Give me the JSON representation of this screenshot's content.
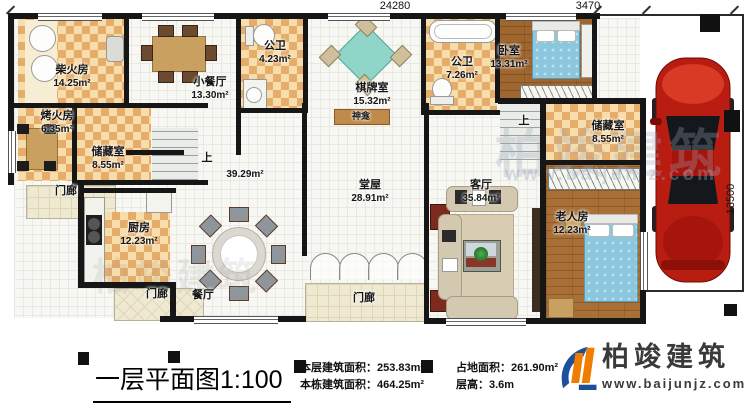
{
  "dimensions": {
    "width_total": "24280",
    "carport_width": "3470",
    "height_total": "13500"
  },
  "rooms": {
    "firewood": {
      "name": "柴火房",
      "area": "14.25m²"
    },
    "small_dining": {
      "name": "小餐厅",
      "area": "13.30m²"
    },
    "bath1": {
      "name": "公卫",
      "area": "4.23m²"
    },
    "game_room": {
      "name": "棋牌室",
      "area": "15.32m²"
    },
    "bath2": {
      "name": "公卫",
      "area": "7.26m²"
    },
    "bedroom": {
      "name": "卧室",
      "area": "13.31m²"
    },
    "storage_right": {
      "name": "储藏室",
      "area": "8.55m²"
    },
    "stove_room": {
      "name": "烤火房",
      "area": "6.35m²"
    },
    "storage_left": {
      "name": "储藏室",
      "area": "8.55m²"
    },
    "kitchen": {
      "name": "厨房",
      "area": "12.23m²"
    },
    "dining": {
      "name": "餐厅",
      "area": "39.29m²"
    },
    "main_hall": {
      "name": "堂屋",
      "area": "28.91m²"
    },
    "living": {
      "name": "客厅",
      "area": "35.84m²"
    },
    "elder_room": {
      "name": "老人房",
      "area": "12.23m²"
    },
    "shrine": {
      "name": "神龛"
    },
    "porch": {
      "name": "门廊"
    }
  },
  "labels": {
    "stairs_up": "上"
  },
  "watermark": {
    "brand": "柏竣建筑",
    "url": "www.baijunjz.com"
  },
  "footer": {
    "title": "一层平面图",
    "scale": "1:100",
    "stats": [
      {
        "label": "本层建筑面积：",
        "value": "253.83m²"
      },
      {
        "label": "本栋建筑面积：",
        "value": "464.25m²"
      },
      {
        "label": "占地面积：",
        "value": "261.90m²"
      },
      {
        "label": "层高：",
        "value": "3.6m"
      }
    ],
    "logo": {
      "brand": "柏竣建筑",
      "url": "www.baijunjz.com"
    }
  }
}
